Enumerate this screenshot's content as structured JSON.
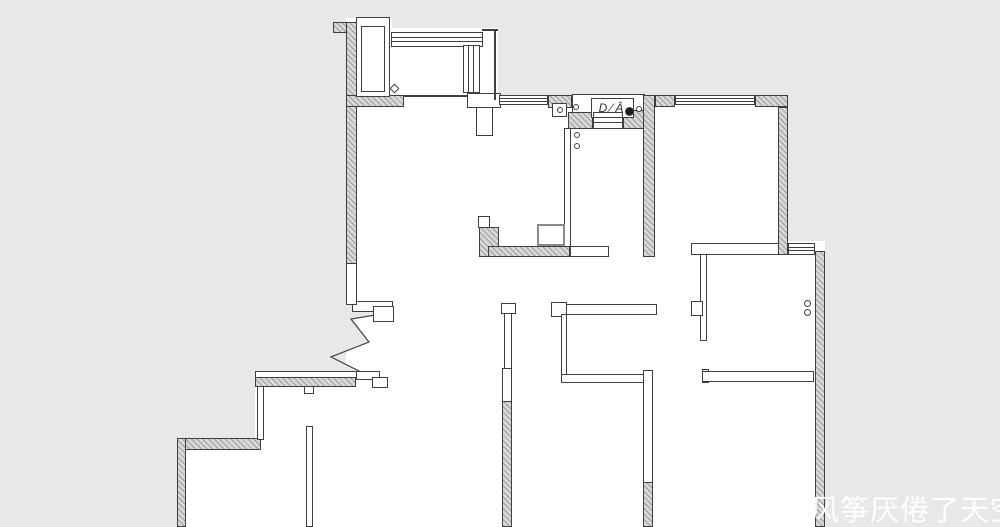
{
  "watermark": {
    "text": "风筝厌倦了天空",
    "x": 810,
    "y": 487,
    "size": 29,
    "color": "rgba(255,255,255,0.95)"
  },
  "entry_label": {
    "text": "D⁄Ā",
    "x": 591,
    "y": 98,
    "w": 43,
    "h": 20
  },
  "plan": {
    "colors": {
      "bg": "#e8e8e8",
      "floor": "#ffffff",
      "line": "#3f3f3f",
      "hatch_line": "#9c9c9c",
      "hatch_bg": "#d8d8d8",
      "flue_border": "#8a8a8a",
      "dot_fill": "#1a1a1a"
    },
    "floors": [
      {
        "n": "shaft-floor",
        "r": [
          346,
          18,
          46,
          89
        ]
      },
      {
        "n": "balcony-floor",
        "r": [
          392,
          28,
          106,
          79
        ]
      },
      {
        "n": "upper-rooms-floor",
        "r": [
          346,
          95,
          442,
          162
        ]
      },
      {
        "n": "side-window-floor",
        "r": [
          788,
          241,
          37,
          14
        ]
      },
      {
        "n": "lower-rooms-floor",
        "r": [
          346,
          255,
          479,
          272
        ]
      },
      {
        "n": "bottom-left-room-floor",
        "r": [
          255,
          371,
          100,
          156
        ]
      },
      {
        "n": "bottom-left-room2-floor",
        "r": [
          177,
          438,
          86,
          89
        ]
      },
      {
        "n": "entry-porch-floor",
        "r": [
          572,
          94,
          73,
          34
        ],
        "border": true
      }
    ],
    "hatched_walls": [
      [
        333,
        22,
        15,
        11
      ],
      [
        346,
        22,
        11,
        243
      ],
      [
        346,
        95,
        58,
        12
      ],
      [
        548,
        95,
        24,
        13
      ],
      [
        568,
        112,
        25,
        17
      ],
      [
        623,
        110,
        32,
        19
      ],
      [
        643,
        95,
        12,
        162
      ],
      [
        655,
        95,
        20,
        12
      ],
      [
        755,
        95,
        33,
        12
      ],
      [
        778,
        107,
        10,
        148
      ],
      [
        815,
        251,
        10,
        276
      ],
      [
        479,
        227,
        20,
        30
      ],
      [
        488,
        246,
        82,
        11
      ],
      [
        255,
        377,
        101,
        10
      ],
      [
        177,
        438,
        84,
        12
      ],
      [
        177,
        438,
        9,
        89
      ],
      [
        502,
        400,
        10,
        127
      ],
      [
        643,
        481,
        10,
        46
      ]
    ],
    "thin_walls": [
      [
        356,
        17,
        34,
        80
      ],
      [
        361,
        26,
        24,
        66
      ],
      [
        467,
        93,
        34,
        15
      ],
      [
        476,
        107,
        17,
        29
      ],
      [
        552,
        103,
        15,
        14
      ],
      [
        591,
        98,
        43,
        20
      ],
      [
        564,
        128,
        7,
        119
      ],
      [
        478,
        216,
        12,
        12
      ],
      [
        570,
        246,
        39,
        11
      ],
      [
        691,
        243,
        88,
        12
      ],
      [
        700,
        254,
        7,
        87
      ],
      [
        691,
        301,
        12,
        15
      ],
      [
        551,
        302,
        16,
        15
      ],
      [
        566,
        304,
        91,
        11
      ],
      [
        561,
        314,
        6,
        64
      ],
      [
        561,
        374,
        84,
        9
      ],
      [
        643,
        370,
        10,
        113
      ],
      [
        501,
        303,
        15,
        11
      ],
      [
        504,
        313,
        8,
        57
      ],
      [
        502,
        368,
        10,
        34
      ],
      [
        702,
        369,
        7,
        14
      ],
      [
        702,
        371,
        112,
        11
      ],
      [
        352,
        301,
        41,
        11
      ],
      [
        373,
        306,
        21,
        16
      ],
      [
        255,
        371,
        113,
        7
      ],
      [
        304,
        386,
        10,
        8
      ],
      [
        257,
        386,
        7,
        54
      ],
      [
        306,
        426,
        7,
        101
      ],
      [
        356,
        371,
        24,
        9
      ],
      [
        372,
        377,
        16,
        11
      ],
      [
        346,
        263,
        11,
        42
      ]
    ],
    "windows": [
      {
        "r": [
          391,
          32,
          92,
          15
        ],
        "o": "h"
      },
      {
        "r": [
          463,
          45,
          17,
          48
        ],
        "o": "v"
      },
      {
        "r": [
          499,
          95,
          49,
          10
        ],
        "o": "h"
      },
      {
        "r": [
          675,
          95,
          80,
          10
        ],
        "o": "h"
      },
      {
        "r": [
          788,
          243,
          27,
          12
        ],
        "o": "h"
      },
      {
        "r": [
          593,
          112,
          30,
          17
        ],
        "o": "h"
      }
    ],
    "lines": [
      [
        482,
        29,
        16,
        2
      ],
      [
        494,
        29,
        2,
        71
      ],
      [
        404,
        95,
        63,
        2
      ]
    ],
    "flue": [
      537,
      224,
      28,
      22
    ],
    "diamond": [
      391,
      85,
      7,
      7
    ],
    "circles": [
      {
        "c": [
          557,
          107,
          6
        ]
      },
      {
        "c": [
          573,
          104,
          6
        ]
      },
      {
        "c": [
          636,
          106,
          6
        ]
      },
      {
        "c": [
          625,
          107,
          9
        ],
        "f": true
      },
      {
        "c": [
          574,
          132,
          6
        ]
      },
      {
        "c": [
          574,
          143,
          6
        ]
      },
      {
        "c": [
          804,
          300,
          7
        ]
      },
      {
        "c": [
          804,
          309,
          7
        ]
      }
    ],
    "break_line": {
      "fill": "346,302 393,312 351,319 369,342 331,357 361,372 346,378",
      "stroke": "393,312 351,319 369,342 331,357 361,372"
    }
  }
}
